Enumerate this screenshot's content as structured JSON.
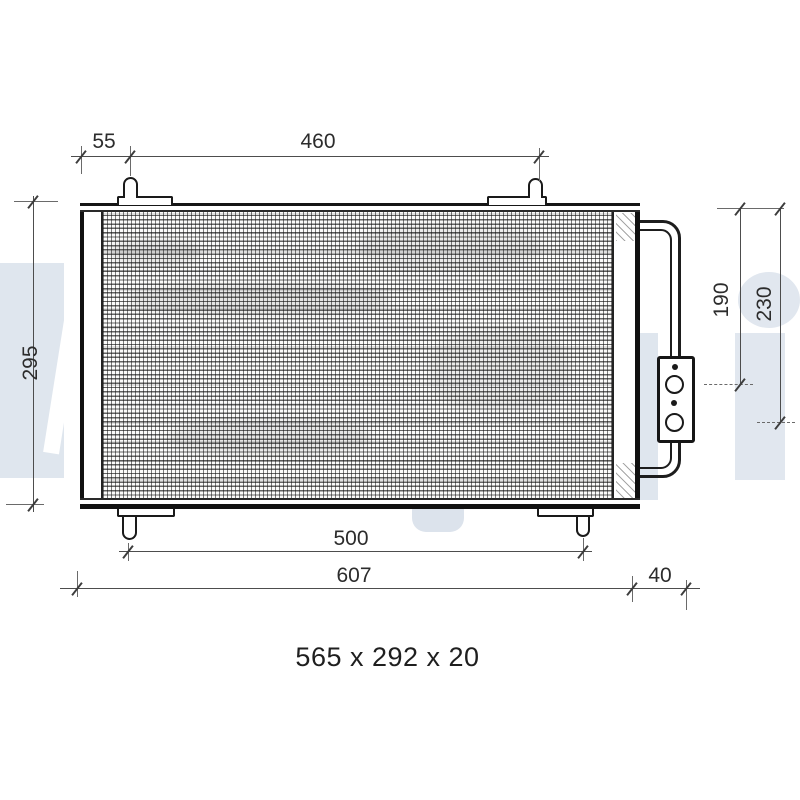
{
  "meta": {
    "type": "technical-dimension-drawing",
    "subject": "air conditioning condenser with receiver drier, front view"
  },
  "watermark": {
    "brand": "Delphi",
    "color": "#dfe6ee"
  },
  "colors": {
    "line": "#1d1d1d",
    "dim_line": "#4d4d4d",
    "label": "#2c2c2c",
    "background": "#ffffff"
  },
  "dims": {
    "top_offset": "55",
    "top_span": "460",
    "left_height": "295",
    "right_upper": "190",
    "right_lower": "230",
    "bottom_span": "500",
    "bottom_total": "607",
    "bottom_right_offset": "40"
  },
  "caption": "565 x 292 x 20"
}
